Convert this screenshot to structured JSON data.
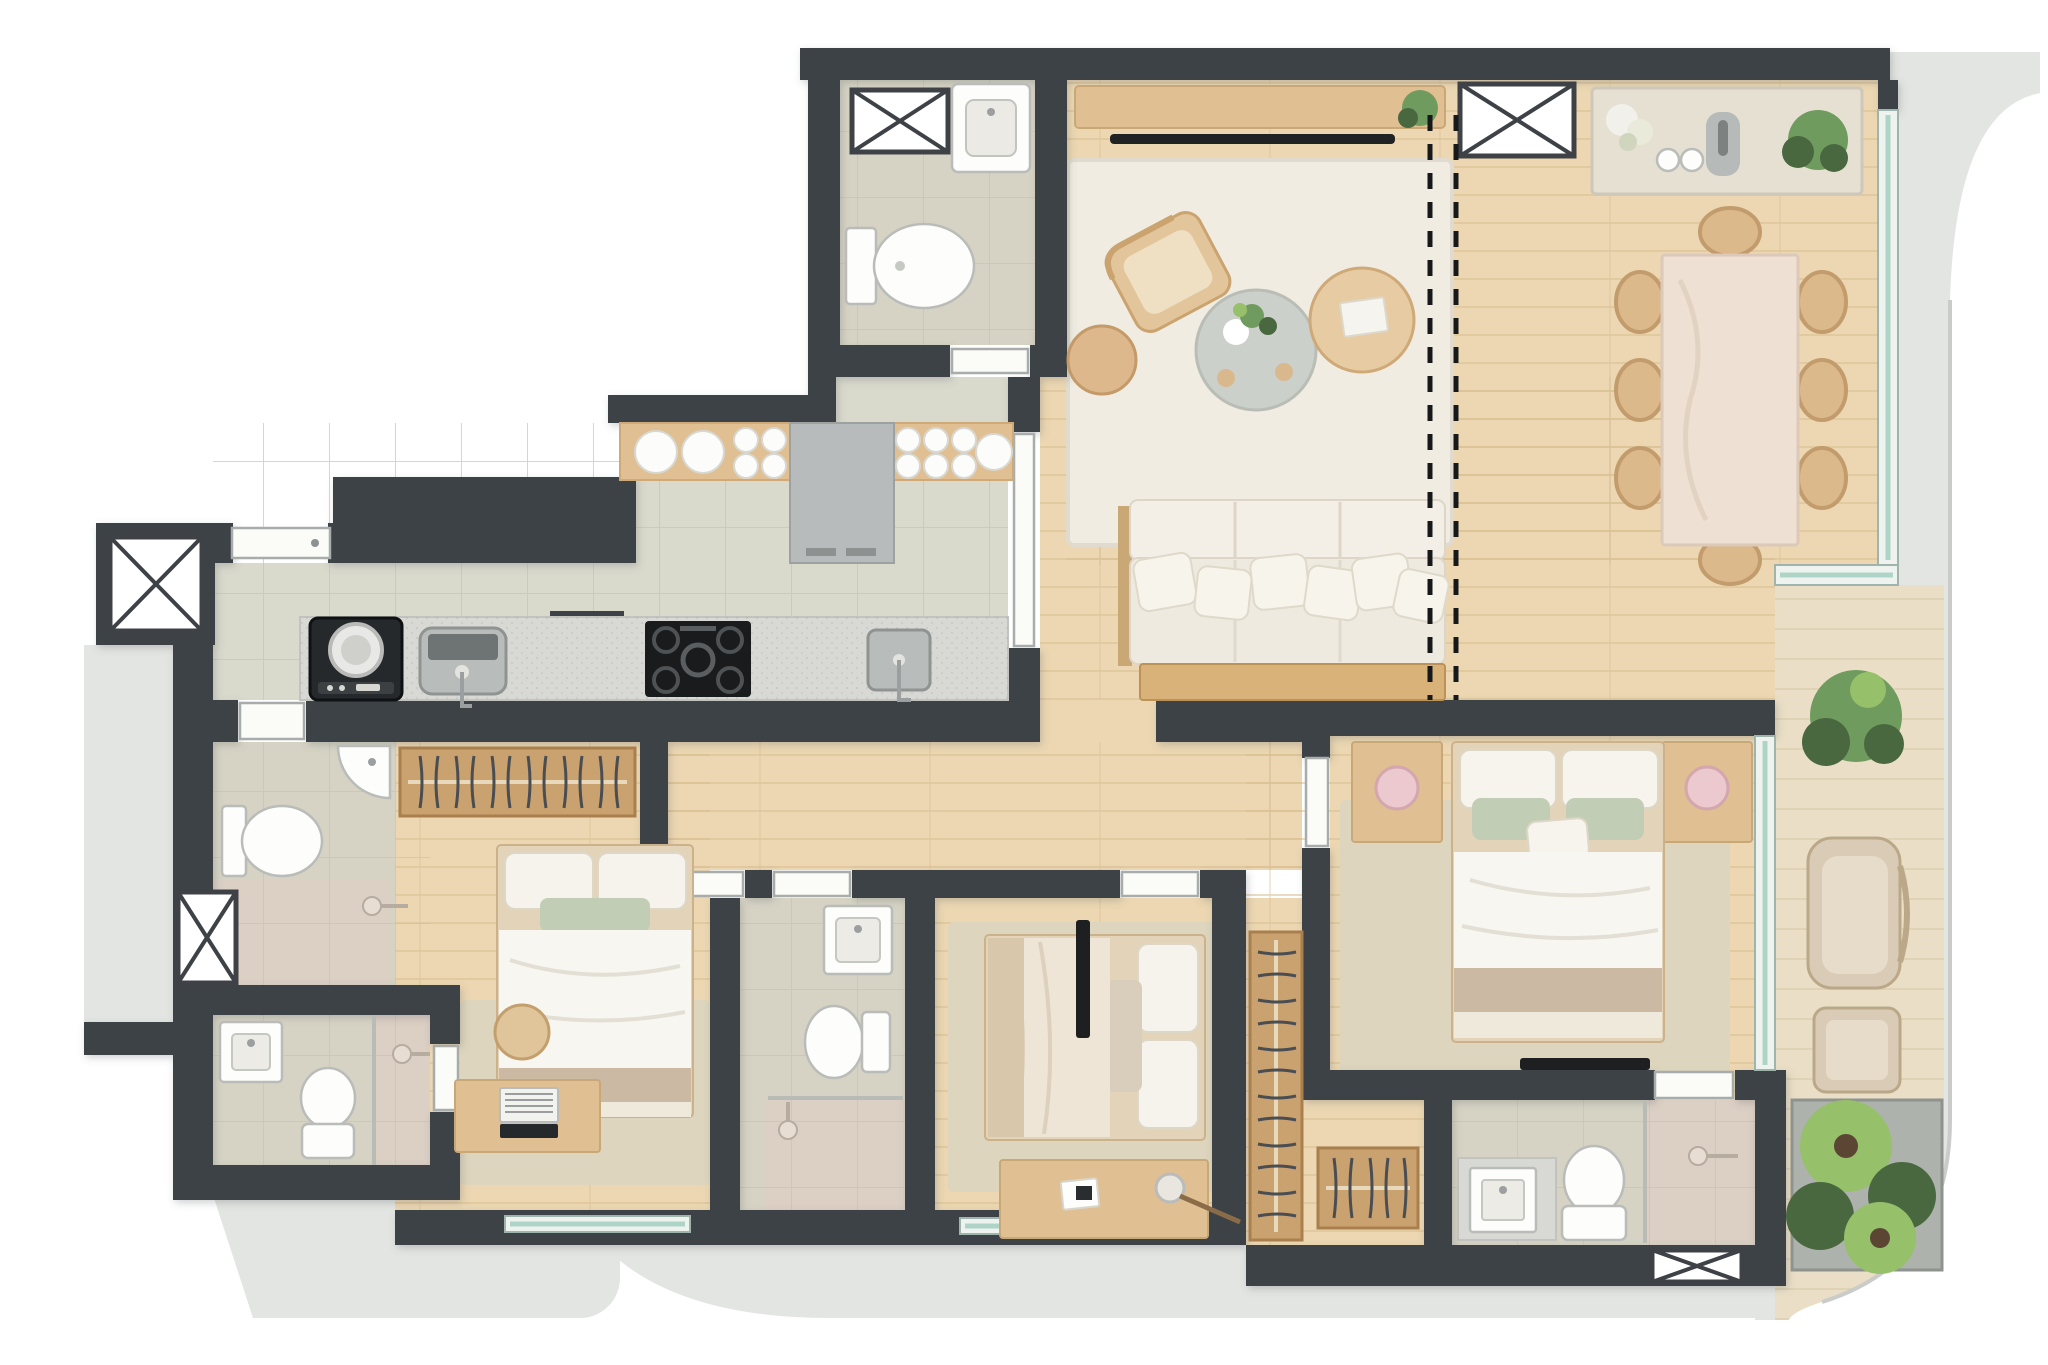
{
  "scene": {
    "type": "apartment-floor-plan-render",
    "view": "top-down",
    "units_note": "3D rendered plan, no text labels visible",
    "dashed_partition_lines": 2
  },
  "palette": {
    "wall": "#3e4247",
    "wood_floor": "#ecd7b2",
    "wood_plank_line": "#d9bd92",
    "tile_floor": "#d9d9cc",
    "bath_floor": "#d6d3c4",
    "shower_floor": "#dccfc4",
    "counter_gray": "#d8d9d4",
    "terrace_gray": "#e3e5e2",
    "deck_wood": "#eadfc6",
    "rug_cream": "#f0ece1",
    "rug_beige": "#ddd5bd",
    "sofa_white": "#f3efe6",
    "wood_furniture": "#e0bf93",
    "stone_table": "#eee0d3",
    "appliance_dark": "#2d3033",
    "fridge_gray": "#b7bbbb",
    "plant_green": "#6f9b5e",
    "plant_dark_green": "#49683f",
    "plant_light_green": "#96c06a",
    "lamp_pink": "#ecc9cf",
    "pillow_sage": "#c2cdb6",
    "blanket_beige": "#cbb9a4",
    "glass_teal": "#aed4c8"
  },
  "rooms": [
    {
      "id": "living-dining",
      "label": "living and dining room",
      "floor": "wood"
    },
    {
      "id": "lavabo",
      "label": "powder room",
      "floor": "tile"
    },
    {
      "id": "kitchen-laundry",
      "label": "kitchen and laundry",
      "floor": "tile"
    },
    {
      "id": "hallway",
      "label": "bedroom hallway",
      "floor": "wood"
    },
    {
      "id": "service-bath",
      "label": "service bathroom",
      "floor": "tile"
    },
    {
      "id": "bathroom-1",
      "label": "bathroom 1",
      "floor": "tile"
    },
    {
      "id": "bedroom-1",
      "label": "bedroom 1",
      "floor": "wood"
    },
    {
      "id": "bathroom-2",
      "label": "bathroom 2",
      "floor": "tile"
    },
    {
      "id": "bedroom-2",
      "label": "bedroom 2",
      "floor": "wood"
    },
    {
      "id": "master-bedroom",
      "label": "master bedroom",
      "floor": "wood"
    },
    {
      "id": "walk-in-closet",
      "label": "walk-in closet",
      "floor": "wood"
    },
    {
      "id": "master-bathroom",
      "label": "master bathroom",
      "floor": "tile"
    },
    {
      "id": "terrace",
      "label": "curved terrace / balcony",
      "floor": "deck"
    },
    {
      "id": "common-corridor",
      "label": "building corridor",
      "floor": "gray"
    }
  ],
  "furniture": {
    "living-dining": [
      "media console",
      "tv-soundbar",
      "console plant",
      "duct shaft",
      "sideboard with flowers and vases",
      "dining table",
      "8 dining chairs",
      "area rug",
      "lounge armchair",
      "wood ottoman",
      "stone coffee table with plant",
      "wood coffee table with book",
      "3-seat sofa with 6 pillows",
      "sofa back console"
    ],
    "lavabo": [
      "duct shaft",
      "wall basin",
      "toilet"
    ],
    "kitchen-laundry": [
      "upper counter with plates",
      "tall fridge cabinet",
      "washing machine",
      "laundry deep sink",
      "duct shaft",
      "5-burner cooktop",
      "kitchen sink",
      "entry door",
      "pocket door to living"
    ],
    "service-bath": [
      "corner basin",
      "toilet",
      "shower head",
      "duct shaft"
    ],
    "bathroom-1": [
      "vanity sink",
      "toilet",
      "shower with glass partition"
    ],
    "bedroom-1": [
      "open wardrobe with hangers",
      "double bed",
      "rug",
      "desk with laptop",
      "chair",
      "window"
    ],
    "bathroom-2": [
      "vanity sink",
      "toilet",
      "shower with glass partition"
    ],
    "bedroom-2": [
      "double bed (headboard east)",
      "rug",
      "desk with lamp and paper",
      "slim tv panel",
      "window"
    ],
    "master-bedroom": [
      "double bed",
      "2 nightstands",
      "2 pink lamps",
      "large rug",
      "wall tv",
      "full-height window"
    ],
    "walk-in-closet": [
      "long hanger rack",
      "short hanger rack"
    ],
    "master-bathroom": [
      "gray vanity with sink",
      "toilet",
      "shower with glass partition",
      "duct shaft"
    ],
    "terrace": [
      "potted plant",
      "outdoor armchair",
      "pouf",
      "planter box with 3 plants"
    ],
    "common-corridor": [
      "2 duct shafts",
      "service entry door"
    ]
  },
  "window_count": 5,
  "duct_shaft_count": 6,
  "door_count": 10
}
